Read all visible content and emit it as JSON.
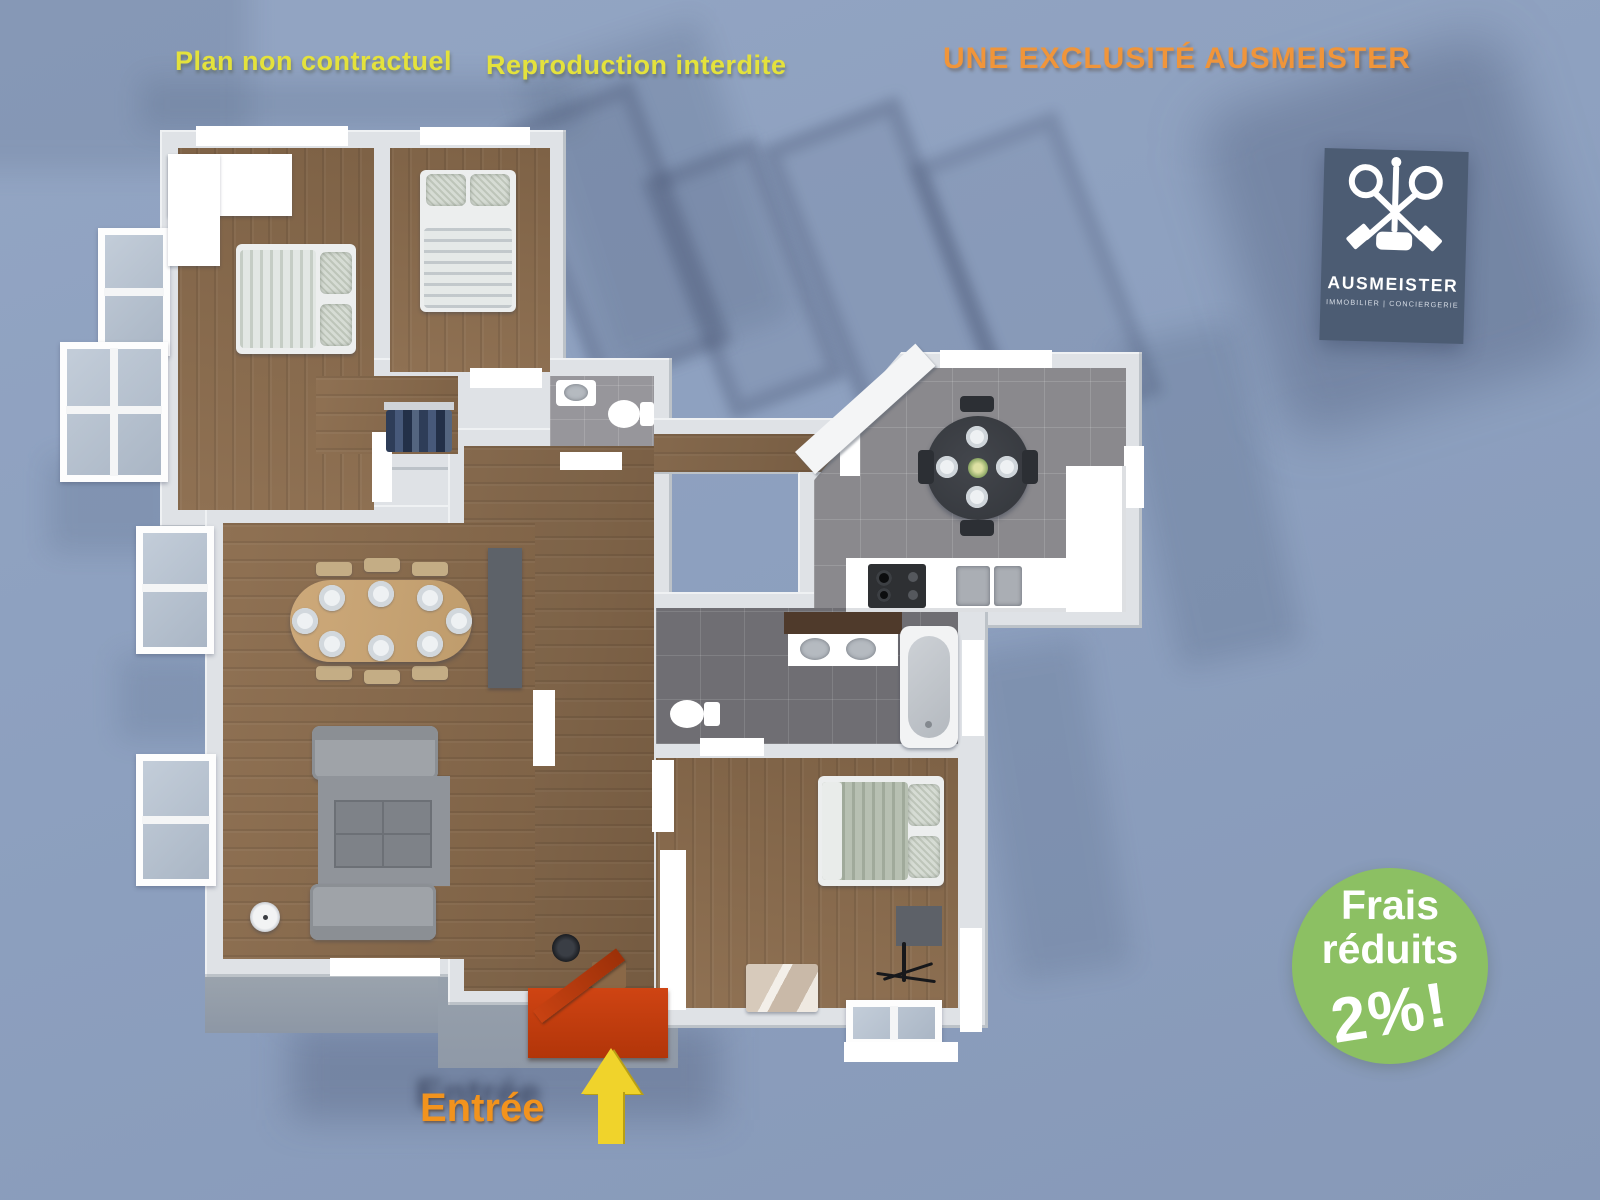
{
  "annotations": {
    "plan_disclaimer": "Plan non contractuel",
    "reproduction_notice": "Reproduction interdite",
    "exclusivity_banner": "UNE EXCLUSITÉ AUSMEISTER",
    "entrance_label": "Entrée"
  },
  "logo": {
    "brand": "AUSMEISTER",
    "tagline": "IMMOBILIER  |  CONCIERGERIE",
    "icon": "crossed-keys-gavel-icon"
  },
  "promo_badge": {
    "line1": "Frais",
    "line2": "réduits",
    "value": "2%!"
  },
  "colors": {
    "background": "#8da0bf",
    "annotation_yellow": "#e4e23c",
    "banner_orange": "#f0953a",
    "entrance_orange": "#f2931d",
    "arrow_yellow": "#f0d32b",
    "badge_green": "#8cc063",
    "logo_navy": "#4c5c73",
    "wall_gray": "#dfe2e6",
    "floor_wood": "#8a6c4e",
    "floor_tile": "#8a898d",
    "door_mat_red": "#c23c10"
  }
}
